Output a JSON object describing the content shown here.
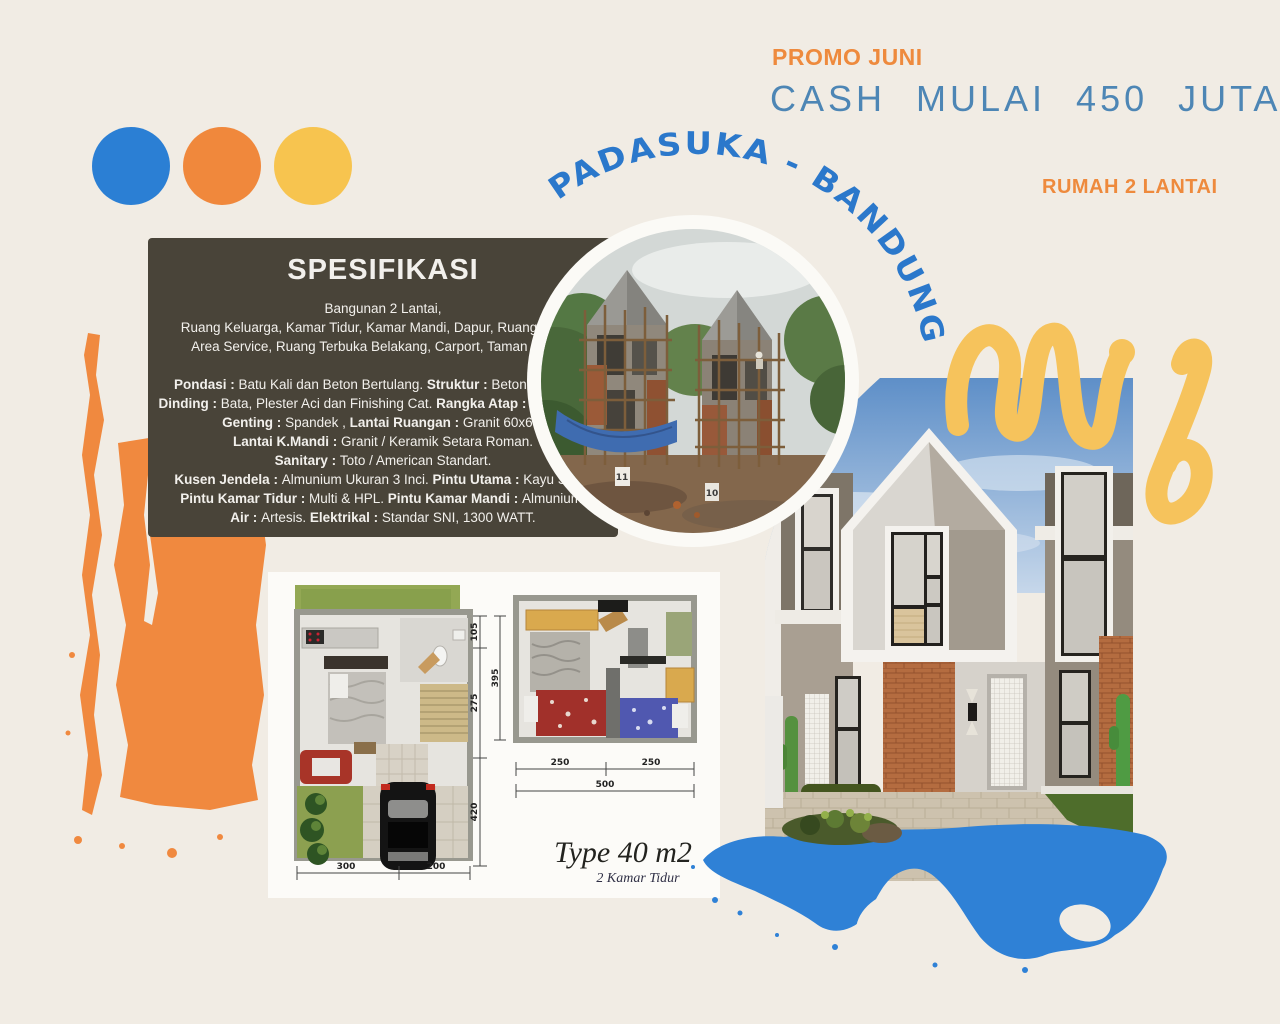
{
  "page": {
    "background": "#f1ece4"
  },
  "palette_dots": {
    "blue": "#2b7fd4",
    "orange": "#f0883c",
    "yellow": "#f7c44f"
  },
  "header": {
    "promo": "PROMO JUNI",
    "price": "CASH MULAI 450 JUTA",
    "subtitle": "RUMAH 2 LANTAI"
  },
  "location_arc": {
    "text": "PADASUKA - BANDUNG"
  },
  "spec": {
    "title": "SPESIFIKASI",
    "lines": [
      [
        {
          "t": "Bangunan 2 Lantai,",
          "b": false
        }
      ],
      [
        {
          "t": "Ruang Keluarga, Kamar Tidur, Kamar Mandi, Dapur, Ruang Makan,",
          "b": false
        }
      ],
      [
        {
          "t": "Area Service, Ruang Terbuka Belakang, Carport, Taman Depan.",
          "b": false
        }
      ],
      [],
      [
        {
          "t": "Pondasi : ",
          "b": true
        },
        {
          "t": "Batu Kali dan Beton Bertulang. ",
          "b": false
        },
        {
          "t": "Struktur : ",
          "b": true
        },
        {
          "t": "Beton Bertulang.",
          "b": false
        }
      ],
      [
        {
          "t": "Dinding : ",
          "b": true
        },
        {
          "t": "Bata, Plester Aci dan Finishing Cat. ",
          "b": false
        },
        {
          "t": "Rangka Atap : ",
          "b": true
        },
        {
          "t": "Baja Ringan.",
          "b": false
        }
      ],
      [
        {
          "t": "Genting : ",
          "b": true
        },
        {
          "t": "Spandek , ",
          "b": false
        },
        {
          "t": "Lantai Ruangan : ",
          "b": true
        },
        {
          "t": "Granit 60x60.",
          "b": false
        }
      ],
      [
        {
          "t": "Lantai K.Mandi : ",
          "b": true
        },
        {
          "t": "Granit / Keramik Setara Roman.",
          "b": false
        }
      ],
      [
        {
          "t": "Sanitary : ",
          "b": true
        },
        {
          "t": "Toto / American Standart.",
          "b": false
        }
      ],
      [
        {
          "t": "Kusen Jendela : ",
          "b": true
        },
        {
          "t": "Almunium Ukuran 3 Inci. ",
          "b": false
        },
        {
          "t": "Pintu Utama : ",
          "b": true
        },
        {
          "t": "Kayu Solid.",
          "b": false
        }
      ],
      [
        {
          "t": "Pintu Kamar Tidur : ",
          "b": true
        },
        {
          "t": "Multi & HPL. ",
          "b": false
        },
        {
          "t": "Pintu Kamar Mandi : ",
          "b": true
        },
        {
          "t": "Almunium.",
          "b": false
        }
      ],
      [
        {
          "t": "Air : ",
          "b": true
        },
        {
          "t": "Artesis. ",
          "b": false
        },
        {
          "t": "Elektrikal : ",
          "b": true
        },
        {
          "t": "Standar SNI, 1300 WATT.",
          "b": false
        }
      ]
    ]
  },
  "construction_photo": {
    "markers": [
      "11",
      "10"
    ]
  },
  "floorplan": {
    "type_label": "Type 40 m2",
    "bedrooms_label": "2 Kamar Tidur",
    "dims": {
      "v105": "105",
      "v395": "395",
      "v275": "275",
      "v420": "420",
      "h250a": "250",
      "h250b": "250",
      "h500": "500",
      "b300": "300",
      "b200": "200"
    }
  },
  "decorations": {
    "brush_orange": "#f0893f",
    "squiggle_yellow": "#f6c35c",
    "splash_blue": "#2f81d6",
    "arc_text_blue": "#2b78cb",
    "price_blue": "#4d86b5",
    "promo_orange": "#ee8a3d",
    "spec_panel_bg": "#494439"
  }
}
